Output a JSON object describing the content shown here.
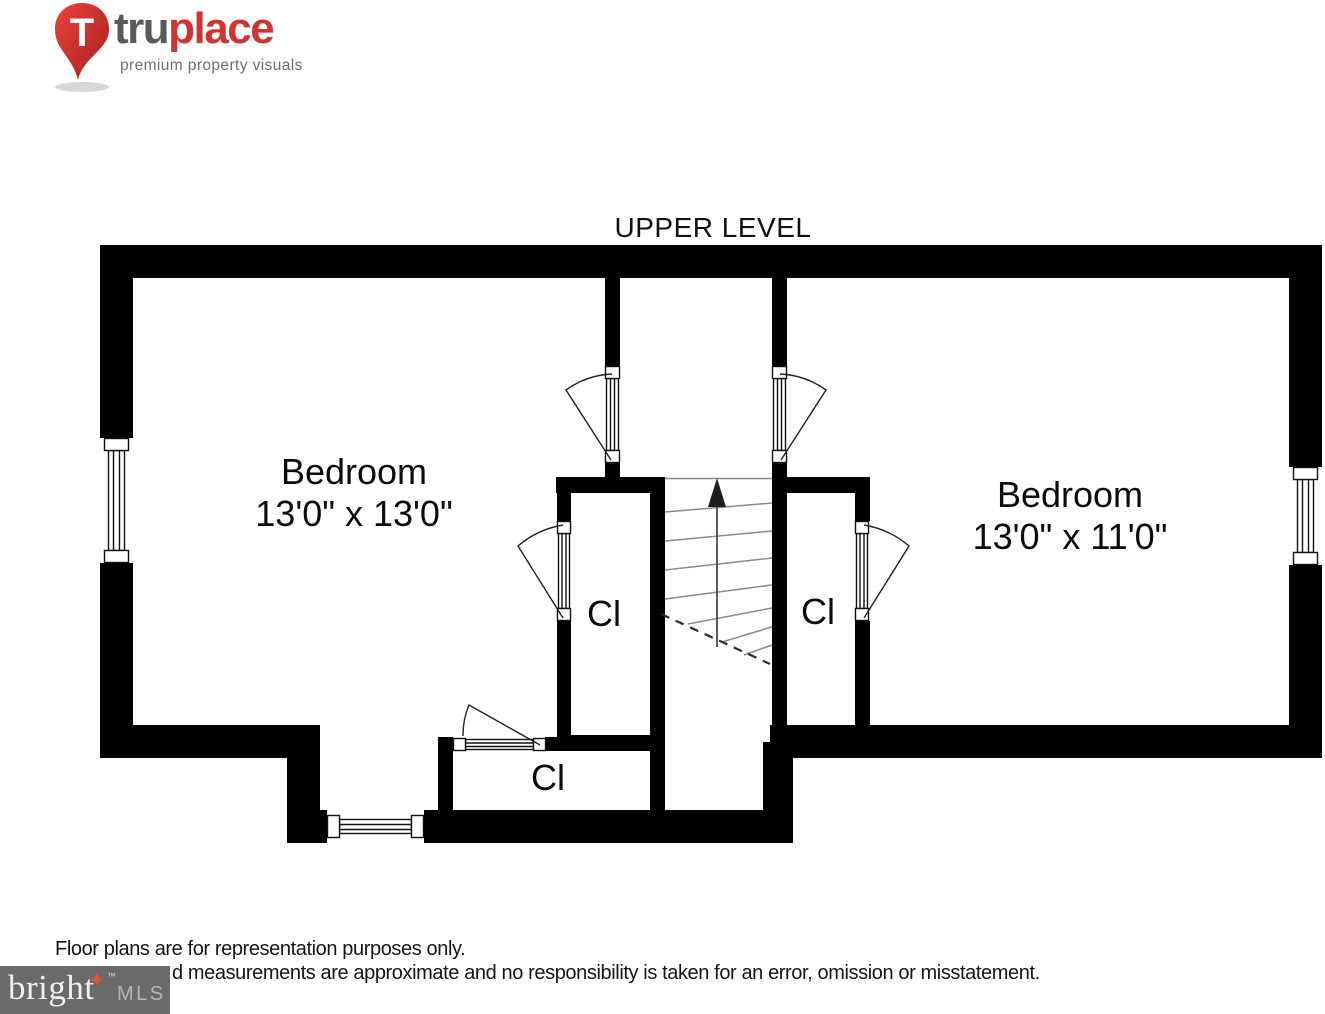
{
  "logo": {
    "brand_primary": "tru",
    "brand_secondary": "place",
    "tagline": "premium property visuals",
    "pin_letter": "T",
    "red": "#d13430",
    "gray": "#58595b"
  },
  "plan": {
    "title": "UPPER LEVEL",
    "rooms": {
      "bedroom_left": {
        "label": "Bedroom",
        "dims": "13'0\" x 13'0\""
      },
      "bedroom_right": {
        "label": "Bedroom",
        "dims": "13'0\" x 11'0\""
      },
      "closet_left": {
        "label": "Cl"
      },
      "closet_right": {
        "label": "Cl"
      },
      "closet_bottom": {
        "label": "Cl"
      }
    },
    "stairs": {
      "direction": "up"
    }
  },
  "footer": {
    "line1": "Floor plans are for representation purposes only.",
    "line2_visible": "d measurements are approximate and no responsibility is taken for an error, omission or misstatement."
  },
  "watermark": {
    "brand": "bright",
    "tm": "™",
    "suffix": "MLS",
    "star": "✦",
    "bg": "#6a6a6a",
    "star_color": "#e0562c"
  }
}
